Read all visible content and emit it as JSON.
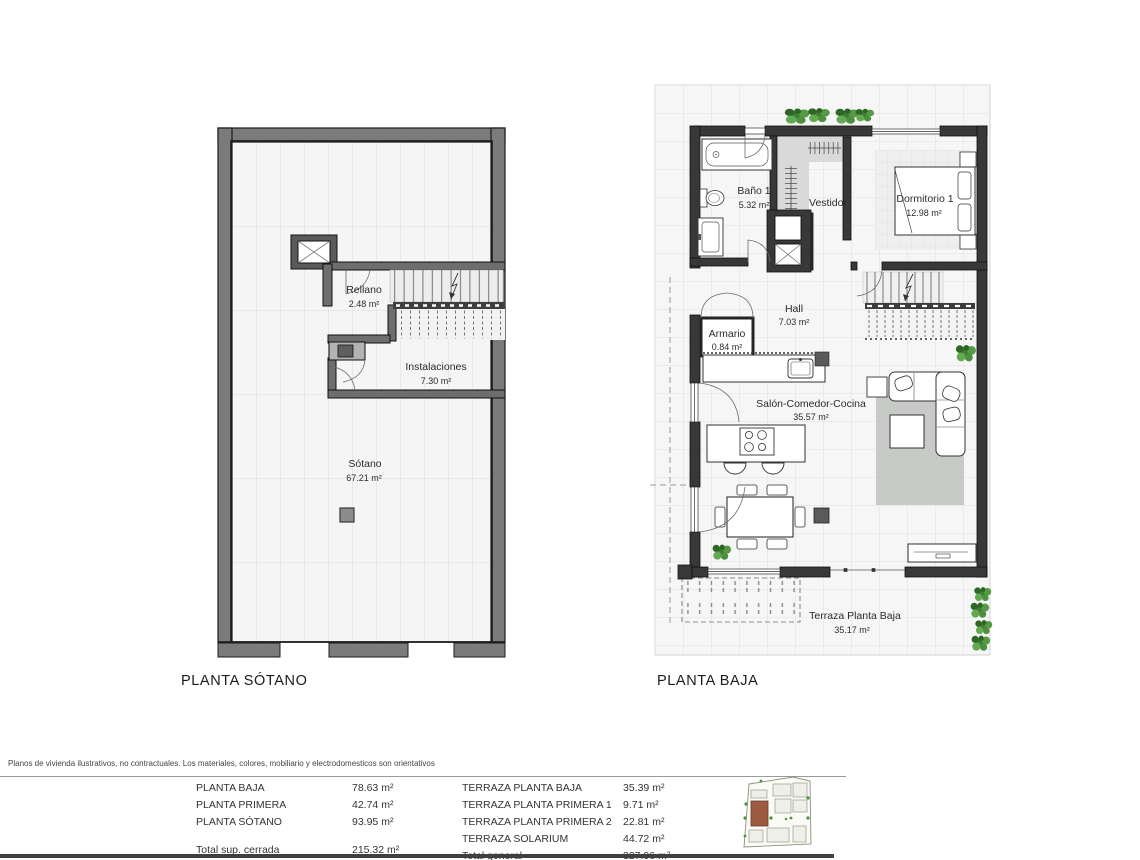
{
  "plans": {
    "sotano": {
      "title": "PLANTA SÓTANO",
      "rooms": [
        {
          "name": "Rellano",
          "area": "2.48 m²"
        },
        {
          "name": "Instalaciones",
          "area": "7.30 m²"
        },
        {
          "name": "Sótano",
          "area": "67.21 m²"
        }
      ]
    },
    "baja": {
      "title": "PLANTA BAJA",
      "rooms": [
        {
          "name": "Baño 1",
          "area": "5.32 m²"
        },
        {
          "name": "Vestidor"
        },
        {
          "name": "Dormitorio 1",
          "area": "12.98 m²"
        },
        {
          "name": "Hall",
          "area": "7.03 m²"
        },
        {
          "name": "Armario",
          "area": "0.84 m²"
        },
        {
          "name": "Salón-Comedor-Cocina",
          "area": "35.57 m²"
        },
        {
          "name": "Terraza Planta Baja",
          "area": "35.17 m²"
        }
      ]
    }
  },
  "footer": {
    "disclaimer": "Planos de vivienda ilustrativos, no contractuales. Los materiales, colores, mobiliario y electrodomesticos son orientativos",
    "closed": {
      "rows": [
        {
          "label": "PLANTA BAJA",
          "value": "78.63 m²"
        },
        {
          "label": "PLANTA PRIMERA",
          "value": "42.74 m²"
        },
        {
          "label": "PLANTA SÓTANO",
          "value": "93.95 m²"
        }
      ],
      "total_label": "Total sup. cerrada",
      "total_value": "215.32 m²"
    },
    "terraces": {
      "rows": [
        {
          "label": "TERRAZA PLANTA BAJA",
          "value": "35.39 m²"
        },
        {
          "label": "TERRAZA PLANTA PRIMERA 1",
          "value": "9.71 m²"
        },
        {
          "label": "TERRAZA PLANTA PRIMERA 2",
          "value": "22.81 m²"
        },
        {
          "label": "TERRAZA SOLARIUM",
          "value": "44.72 m²"
        }
      ],
      "total_label": "Total general",
      "total_value": "327.96 m²"
    }
  },
  "colors": {
    "wall_gray": "#7b7b7b",
    "wall_dark": "#383838",
    "floor": "#f5f5f5",
    "rug": "#c8cac8",
    "closet_gray": "#d9d9d9",
    "plant_green": "#4a8f3c",
    "lot_highlight": "#9e5a41"
  }
}
